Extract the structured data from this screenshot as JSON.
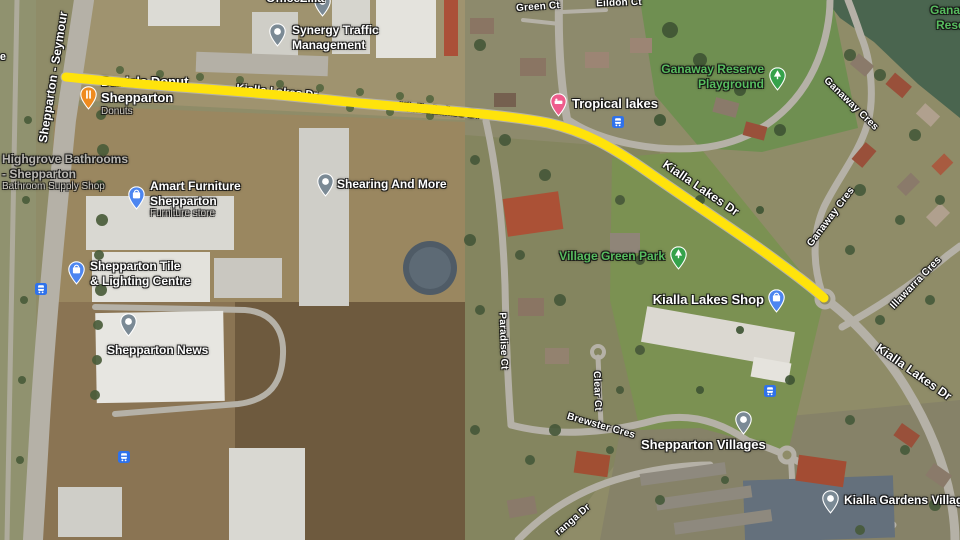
{
  "map_title": "Satellite map - Kialla Lakes Dr, Shepparton",
  "route": {
    "name": "Kialla Lakes Dr",
    "color": "#ffe30b",
    "width": 9,
    "path": "M66 77 C160 87 240 90 330 100 C390 107 490 112 548 123 C585 131 612 147 648 172 C695 205 745 237 778 262 C800 278 814 289 824 298"
  },
  "pin_colors": {
    "gray-dot": "#7b8a95",
    "restaurant": "#ef8b1f",
    "shopping": "#4d86f0",
    "lodging": "#ee5c8c",
    "tree": "#35a24b"
  },
  "transit_color": "#2f72eb",
  "road_labels": [
    {
      "id": "shepparton-seymour",
      "text": "Shepparton - Seymour",
      "x": 53,
      "y": 77,
      "rot": -81,
      "size": 12
    },
    {
      "id": "kialla-lakes-dr-1",
      "text": "Kialla Lakes Dr",
      "x": 277,
      "y": 92,
      "rot": 5,
      "size": 11,
      "under": true
    },
    {
      "id": "kialla-lakes-dr-2",
      "text": "Kialla Lakes Dr",
      "x": 440,
      "y": 111,
      "rot": 6,
      "size": 11,
      "under": true
    },
    {
      "id": "kialla-lakes-dr-3",
      "text": "Kialla Lakes Dr",
      "x": 701,
      "y": 188,
      "rot": 34,
      "size": 12
    },
    {
      "id": "kialla-lakes-dr-4",
      "text": "Kialla Lakes Dr",
      "x": 914,
      "y": 372,
      "rot": 35,
      "size": 12
    },
    {
      "id": "green-ct",
      "text": "Green Ct",
      "x": 538,
      "y": 7,
      "rot": -4,
      "size": 10
    },
    {
      "id": "eildon-ct",
      "text": "Eildon Ct",
      "x": 619,
      "y": 3,
      "rot": -2,
      "size": 10
    },
    {
      "id": "ganaway-cres-north",
      "text": "Ganaway Cres",
      "x": 851,
      "y": 104,
      "rot": 44,
      "size": 10
    },
    {
      "id": "ganaway-cres-south",
      "text": "Ganaway Cres",
      "x": 831,
      "y": 217,
      "rot": -53,
      "size": 10
    },
    {
      "id": "illawarra-cres",
      "text": "Illawarra Cres",
      "x": 916,
      "y": 283,
      "rot": -46,
      "size": 10
    },
    {
      "id": "paradise-ct",
      "text": "Paradise Ct",
      "x": 503,
      "y": 341,
      "rot": 88,
      "size": 10
    },
    {
      "id": "clear-ct",
      "text": "Clear Ct",
      "x": 597,
      "y": 391,
      "rot": 88,
      "size": 10
    },
    {
      "id": "brewster-cres",
      "text": "Brewster Cres",
      "x": 601,
      "y": 426,
      "rot": 16,
      "size": 10
    },
    {
      "id": "ranga-dr",
      "text": "ranga Dr",
      "x": 573,
      "y": 520,
      "rot": -41,
      "size": 10
    },
    {
      "id": "edge-fragment",
      "text": "e",
      "x": 3,
      "y": 57,
      "rot": 0,
      "size": 11
    }
  ],
  "pois": [
    {
      "id": "officezilla",
      "style": "white",
      "size": 12,
      "lines": [
        "OfficeZilla"
      ],
      "lx": 266,
      "ly": -9,
      "pin": "gray-dot",
      "px": 322,
      "py": 1
    },
    {
      "id": "synergy-traffic-management",
      "style": "white",
      "size": 12,
      "lines": [
        "Synergy Traffic",
        "Management"
      ],
      "lx": 292,
      "ly": 23,
      "pin": "gray-dot",
      "px": 277,
      "py": 31
    },
    {
      "id": "daniels-donut-shepparton",
      "style": "white",
      "size": 13,
      "lines": [
        "Daniels Donut",
        "Shepparton"
      ],
      "sub": "Donuts",
      "lx": 101,
      "ly": 74,
      "pin": "restaurant",
      "px": 88,
      "py": 94,
      "under": true
    },
    {
      "id": "highgrove-bathrooms",
      "style": "gray",
      "size": 12,
      "lines": [
        "Highgrove Bathrooms",
        "- Shepparton"
      ],
      "sub": "Bathroom Supply Shop",
      "lx": 2,
      "ly": 152
    },
    {
      "id": "amart-furniture-shepparton",
      "style": "white",
      "size": 12,
      "lines": [
        "Amart Furniture",
        "Shepparton"
      ],
      "sub": "Furniture store",
      "lx": 150,
      "ly": 179,
      "pin": "shopping",
      "px": 136,
      "py": 194
    },
    {
      "id": "shearing-and-more",
      "style": "white",
      "size": 12,
      "lines": [
        "Shearing And More"
      ],
      "lx": 337,
      "ly": 177,
      "pin": "gray-dot",
      "px": 325,
      "py": 181
    },
    {
      "id": "shepparton-tile-lighting",
      "style": "white",
      "size": 12,
      "lines": [
        "Shepparton Tile",
        "& Lighting Centre"
      ],
      "lx": 90,
      "ly": 259,
      "pin": "shopping",
      "px": 76,
      "py": 269
    },
    {
      "id": "shepparton-news",
      "style": "white",
      "size": 12,
      "lines": [
        "Shepparton News"
      ],
      "lx": 107,
      "ly": 343,
      "pin": "gray-dot",
      "px": 128,
      "py": 321
    },
    {
      "id": "tropical-lakes",
      "style": "white",
      "size": 13,
      "lines": [
        "Tropical lakes"
      ],
      "lx": 572,
      "ly": 96,
      "pin": "lodging",
      "px": 558,
      "py": 101
    },
    {
      "id": "ganaway-reserve-playground",
      "style": "green",
      "size": 12,
      "lines": [
        "Ganaway Reserve",
        "Playground"
      ],
      "rx": 764,
      "ly": 62,
      "pin": "tree",
      "px": 777,
      "py": 75
    },
    {
      "id": "village-green-park",
      "style": "green",
      "size": 12,
      "lines": [
        "Village Green Park"
      ],
      "rx": 665,
      "ly": 249,
      "pin": "tree",
      "px": 678,
      "py": 254
    },
    {
      "id": "kialla-lakes-shop",
      "style": "white",
      "size": 13,
      "lines": [
        "Kialla Lakes Shop"
      ],
      "rx": 764,
      "ly": 292,
      "pin": "shopping",
      "px": 776,
      "py": 297
    },
    {
      "id": "shepparton-villages",
      "style": "white",
      "size": 13,
      "lines": [
        "Shepparton Villages"
      ],
      "lx": 641,
      "ly": 437,
      "pin": "gray-dot",
      "px": 743,
      "py": 419
    },
    {
      "id": "kialla-gardens-village",
      "style": "white",
      "size": 12,
      "lines": [
        "Kialla Gardens Village"
      ],
      "lx": 844,
      "ly": 493,
      "pin": "gray-dot",
      "px": 830,
      "py": 498
    },
    {
      "id": "ganaway-reserve-corner",
      "style": "green",
      "size": 12,
      "lines": [
        "Ganaway",
        "Reserve"
      ],
      "lx": 930,
      "ly": 3,
      "indent2": 6
    }
  ],
  "transit_stops": [
    {
      "id": "stop-highway",
      "x": 41,
      "y": 288
    },
    {
      "id": "stop-news",
      "x": 124,
      "y": 456
    },
    {
      "id": "stop-tropical-lakes",
      "x": 618,
      "y": 121
    },
    {
      "id": "stop-kialla-lakes",
      "x": 770,
      "y": 390
    }
  ]
}
